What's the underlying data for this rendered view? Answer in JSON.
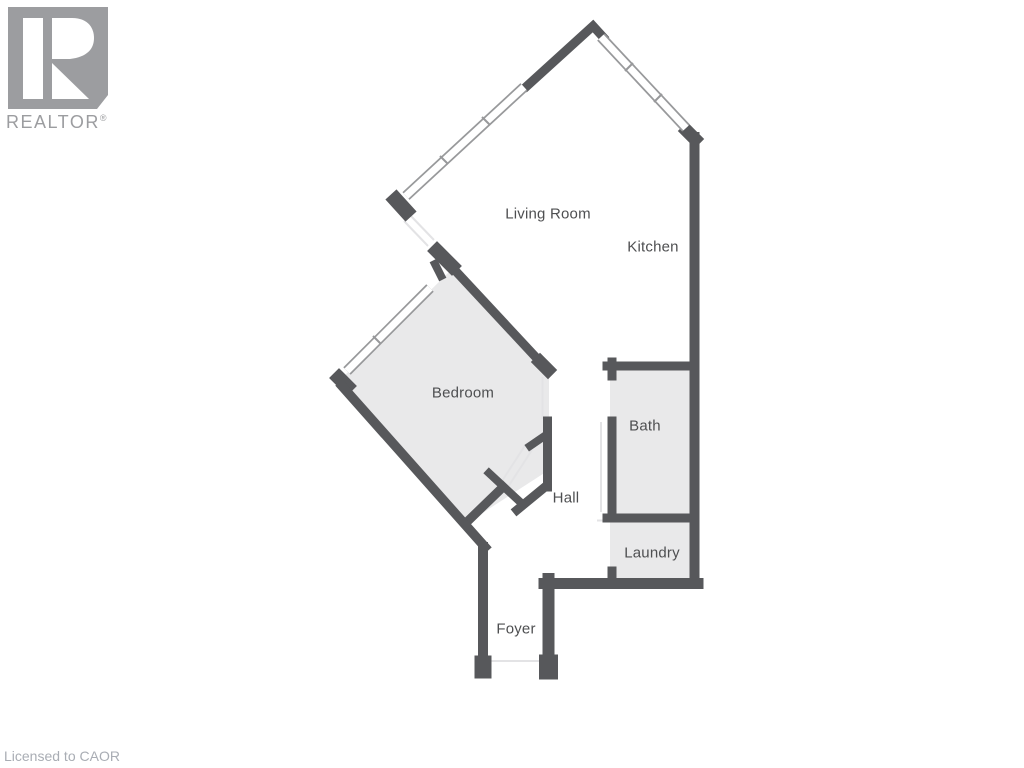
{
  "branding": {
    "logo_word": "REALTOR",
    "registered_mark": "®",
    "license_text": "Licensed to CAOR"
  },
  "floorplan": {
    "rooms": [
      {
        "id": "living-room",
        "label": "Living Room"
      },
      {
        "id": "kitchen",
        "label": "Kitchen"
      },
      {
        "id": "bedroom",
        "label": "Bedroom"
      },
      {
        "id": "bath",
        "label": "Bath"
      },
      {
        "id": "hall",
        "label": "Hall"
      },
      {
        "id": "laundry",
        "label": "Laundry"
      },
      {
        "id": "foyer",
        "label": "Foyer"
      }
    ]
  },
  "colors": {
    "wall": "#57585B",
    "room_fill": "#E9E9EA",
    "window_border": "#98999B",
    "threshold_line": "#E3E3E5",
    "label_text": "#4E4F51",
    "logo_gray": "#9C9DA0",
    "license_text_color": "#A9ADB4"
  }
}
